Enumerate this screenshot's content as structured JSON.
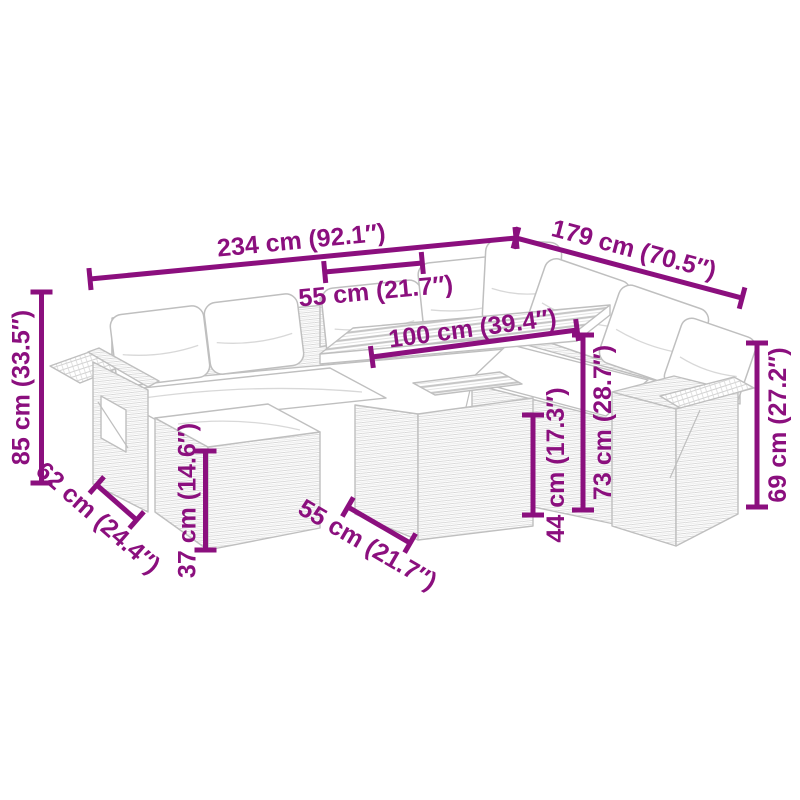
{
  "page": {
    "background": "#ffffff"
  },
  "diagram": {
    "accent_color": "#8B0F7E",
    "line_art_color": "#BFBFBF",
    "subject": "garden-corner-sofa-set-with-table-and-footstool",
    "dimensions": [
      {
        "name": "total-width",
        "label": "234 cm (92.1″)"
      },
      {
        "name": "total-depth",
        "label": "179 cm (70.5″)"
      },
      {
        "name": "back-seat-width",
        "label": "55 cm (21.7″)"
      },
      {
        "name": "table-length",
        "label": "100 cm (39.4″)"
      },
      {
        "name": "backrest-height",
        "label": "85 cm (33.5″)"
      },
      {
        "name": "seat-depth",
        "label": "62 cm (24.4″)"
      },
      {
        "name": "footstool-height",
        "label": "37 cm (14.6″)"
      },
      {
        "name": "front-seat-width",
        "label": "55 cm (21.7″)"
      },
      {
        "name": "table-shelf-height",
        "label": "44 cm (17.3″)"
      },
      {
        "name": "table-top-height",
        "label": "73 cm (28.7″)"
      },
      {
        "name": "armrest-height",
        "label": "69 cm (27.2″)"
      }
    ]
  }
}
